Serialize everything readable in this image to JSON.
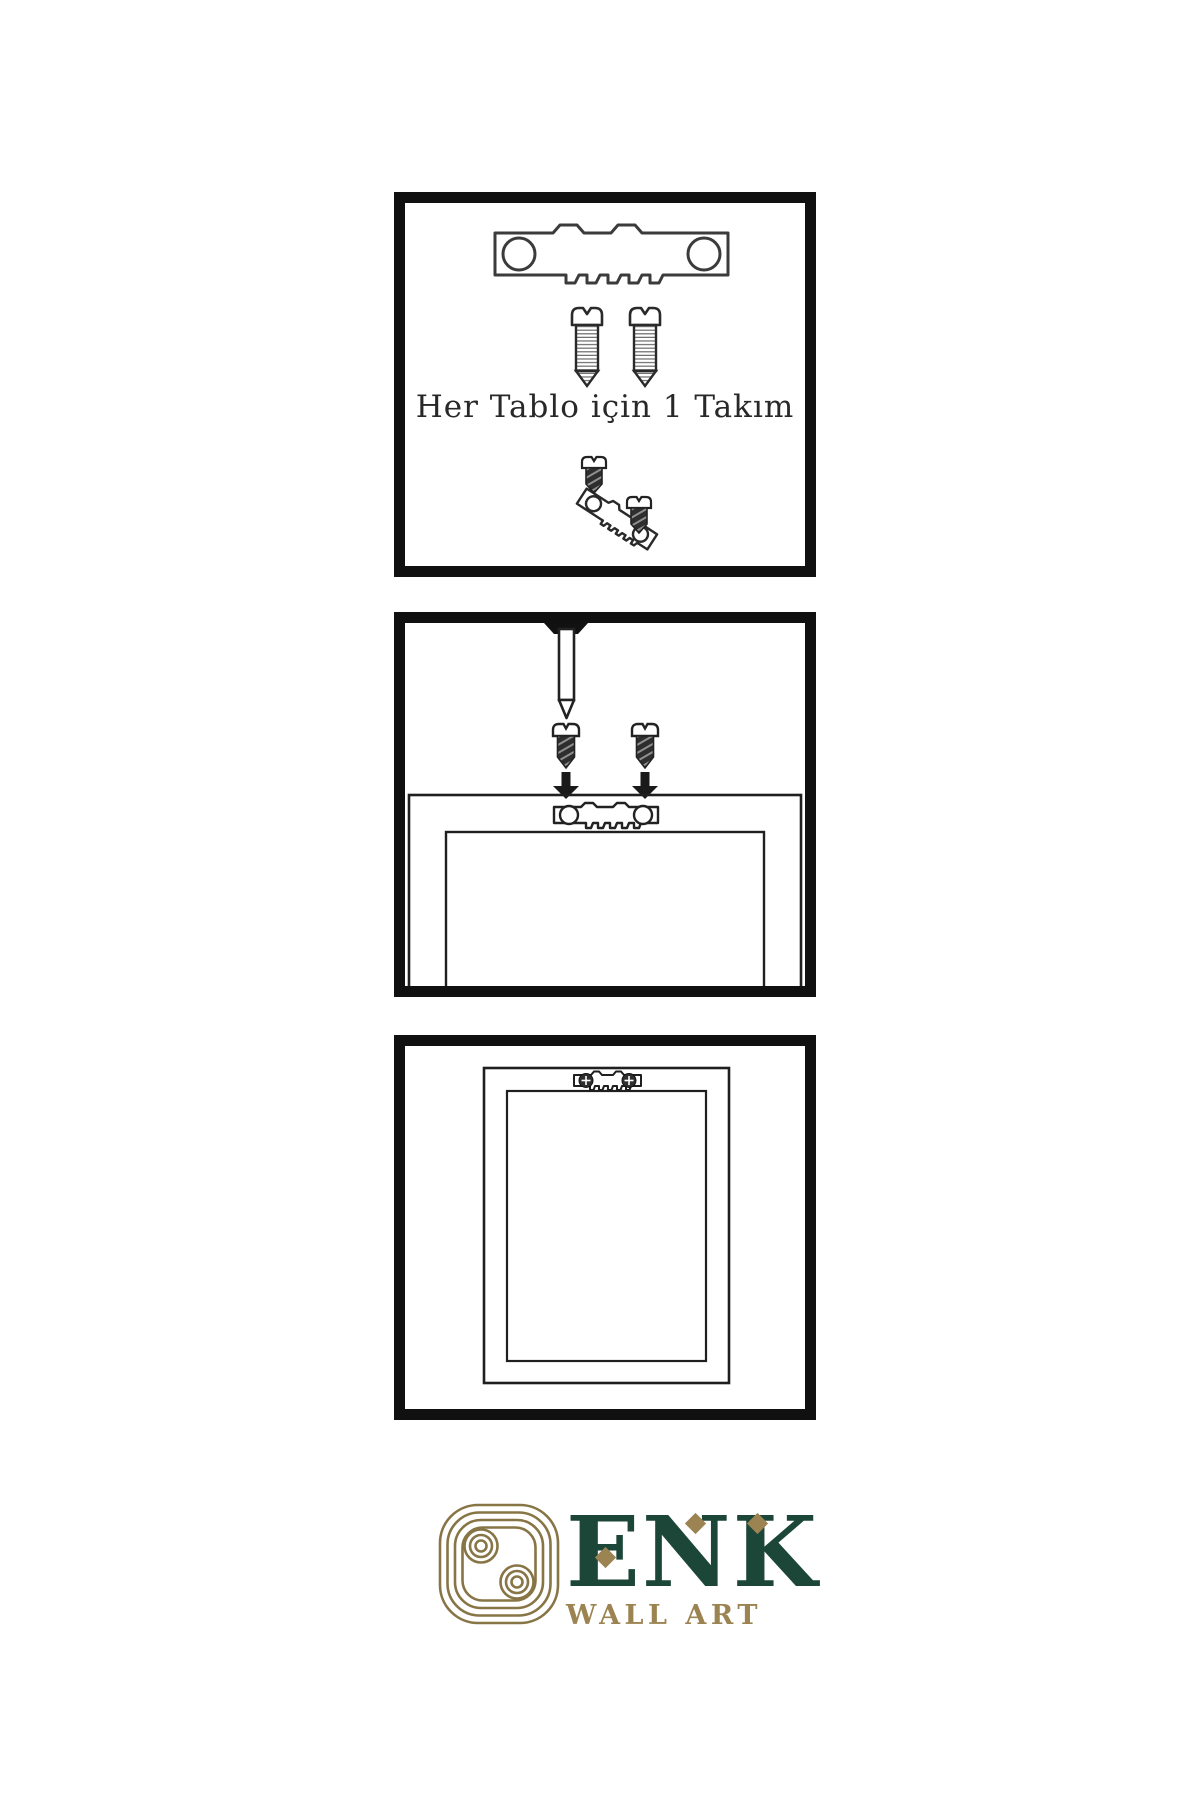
{
  "steps": {
    "step1": {
      "caption": "Her Tablo için 1 Takım"
    }
  },
  "brand": {
    "name": "ENK",
    "tagline": "WALL ART",
    "colors": {
      "green": "#1C4637",
      "gold": "#9B8352",
      "knot_gold": "#877546",
      "line_art": "#2B2B2B",
      "panel_border": "#101010"
    }
  },
  "icons": {
    "sawtooth_hanger": "sawtooth-hanger-icon",
    "screw": "screw-icon",
    "nail": "nail-icon",
    "down_arrow": "down-arrow-icon",
    "knot": "enk-knot-logo-icon",
    "diamond": "diamond-accent-icon"
  }
}
